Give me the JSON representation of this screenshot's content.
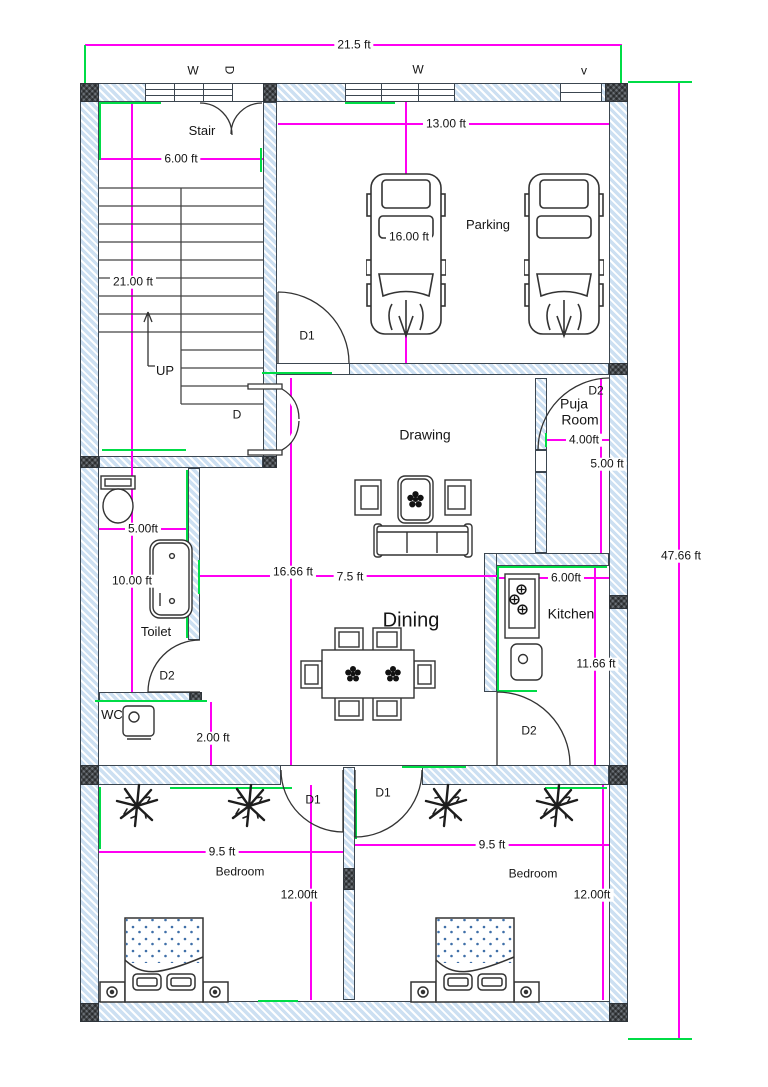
{
  "title": "House Floor Plan",
  "colors": {
    "wall_hatch": "#cde0f2",
    "column": "#6a7076",
    "dimension_line": "#ff00f2",
    "accent_green": "#00dc46",
    "linework": "#3c4650"
  },
  "overall": {
    "width": "21.5 ft",
    "height": "47.66 ft"
  },
  "openings": {
    "window": "W",
    "door": "D",
    "vent": "v",
    "door1": "D1",
    "door2": "D2"
  },
  "rooms": {
    "stair": {
      "name": "Stair",
      "width": "6.00 ft",
      "length": "21.00 ft",
      "direction": "UP"
    },
    "parking": {
      "name": "Parking",
      "width": "13.00 ft",
      "depth": "16.00 ft"
    },
    "drawing": {
      "name": "Drawing",
      "width": "16.66 ft"
    },
    "puja": {
      "line1": "Puja",
      "line2": "Room",
      "width": "4.00ft",
      "depth": "5.00 ft"
    },
    "toilet": {
      "name": "Toilet",
      "width": "5.00ft",
      "depth": "10.00 ft"
    },
    "wc": {
      "name": "WC",
      "width": "2.00 ft"
    },
    "dining": {
      "name": "Dining",
      "width": "7.5 ft"
    },
    "kitchen": {
      "name": "Kitchen",
      "width": "6.00ft",
      "depth": "11.66 ft"
    },
    "bedroom1": {
      "name": "Bedroom",
      "width": "9.5 ft",
      "depth": "12.00ft"
    },
    "bedroom2": {
      "name": "Bedroom",
      "width": "9.5 ft",
      "depth": "12.00ft"
    }
  }
}
